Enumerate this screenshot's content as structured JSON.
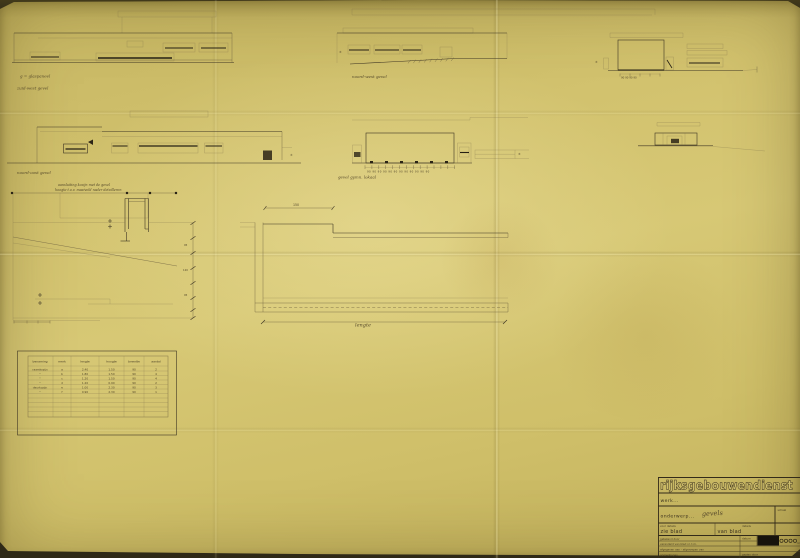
{
  "colors": {
    "paper": "#d2c26e",
    "ink": "#3f3624",
    "ink_faint": "#6e6140",
    "ink_dark": "#262014",
    "black_stamp": "#17130c"
  },
  "annotations": {
    "elev1_cap1": "g = glaspaneel",
    "elev1_cap2": "zuid-west gevel",
    "elev2_cap": "noord-west gevel",
    "elev3_dims": "90 90 90 90",
    "elev4_cap": "noord-oost gevel",
    "elev5_cap": "gevel gymn. lokaal",
    "elev5_dims": "90 90 90 90 90 90 90 90 90 90 90 90",
    "note1": "aansluiting kozijn met de gevel",
    "note2": "hoogte t.o.v. maaiveld nader detailleren",
    "dim_150": "150",
    "dim_v1": "95",
    "dim_v2": "120",
    "dim_v3": "95",
    "lengte": "lengte",
    "pm": "±"
  },
  "table": {
    "headers": [
      "benaming",
      "merk",
      "lengte",
      "hoogte",
      "breedte",
      "aantal"
    ],
    "rows": [
      [
        "raamkozijn",
        "a",
        "2.40",
        "1.50",
        "90",
        "2"
      ],
      [
        "\"",
        "b",
        "1.80",
        "1.50",
        "90",
        "4"
      ],
      [
        "\"",
        "c",
        "1.20",
        "1.50",
        "90",
        "4"
      ],
      [
        "\"",
        "d",
        "1.20",
        "0.90",
        "90",
        "2"
      ],
      [
        "deurkozijn",
        "e",
        "1.00",
        "2.30",
        "90",
        "3"
      ],
      [
        "\"",
        "f",
        "0.90",
        "2.30",
        "90",
        "1"
      ]
    ]
  },
  "titleblock": {
    "agency": "rijksgebouwendienst",
    "werk": "werk...",
    "onderwerp": "onderwerp...",
    "onderwerp_value": "gevels",
    "schaal": "schaal",
    "voor_details": "voor details",
    "zie_blad": "zie blad",
    "details": "details",
    "van_blad": "van blad",
    "getekend": "getekend door",
    "datum": "datum",
    "veranderd": "veranderd van blad nr. t.m.",
    "afgegeven": "afgegeven aan - afgeroepen van",
    "opmerkingen": "opmerkingen...",
    "gezien": "gezien door",
    "blad": "blad"
  }
}
